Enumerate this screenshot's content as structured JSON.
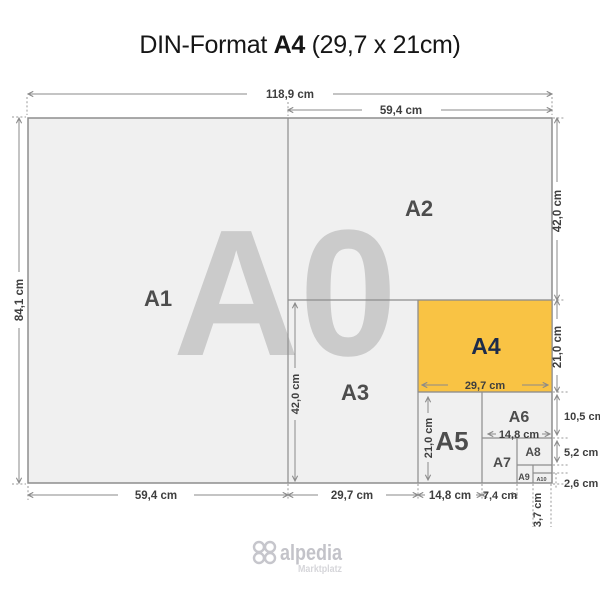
{
  "title": {
    "prefix": "DIN-Format",
    "highlight": "A4",
    "suffix": "(29,7 x 21cm)"
  },
  "watermark": "A0",
  "formats": {
    "a1": "A1",
    "a2": "A2",
    "a3": "A3",
    "a4": "A4",
    "a5": "A5",
    "a6": "A6",
    "a7": "A7",
    "a8": "A8",
    "a9": "A9",
    "a10": "A10"
  },
  "dims": {
    "a0_width": "118,9 cm",
    "a0_height": "84,1 cm",
    "a1_width": "59,4 cm",
    "a2_width": "59,4 cm",
    "a2_height": "42,0 cm",
    "a3_width": "29,7 cm",
    "a3_height": "42,0 cm",
    "a4_width": "29,7 cm",
    "a4_height": "21,0 cm",
    "a5_width": "14,8 cm",
    "a5_height": "21,0 cm",
    "a6_width": "14,8 cm",
    "a6_height": "10,5 cm",
    "a7_width": "7,4 cm",
    "a8_height": "5,2 cm",
    "a10_width": "3,7 cm",
    "a10_height": "2,6 cm"
  },
  "logo": {
    "name": "alpedia",
    "tagline": "Marktplatz"
  },
  "colors": {
    "highlight": "#f9c344",
    "paper": "#f0f0f0",
    "line": "#8d8d8d",
    "watermark": "#cbcbcb",
    "label": "#4d4d4d",
    "a4_label": "#1d2b4a"
  }
}
